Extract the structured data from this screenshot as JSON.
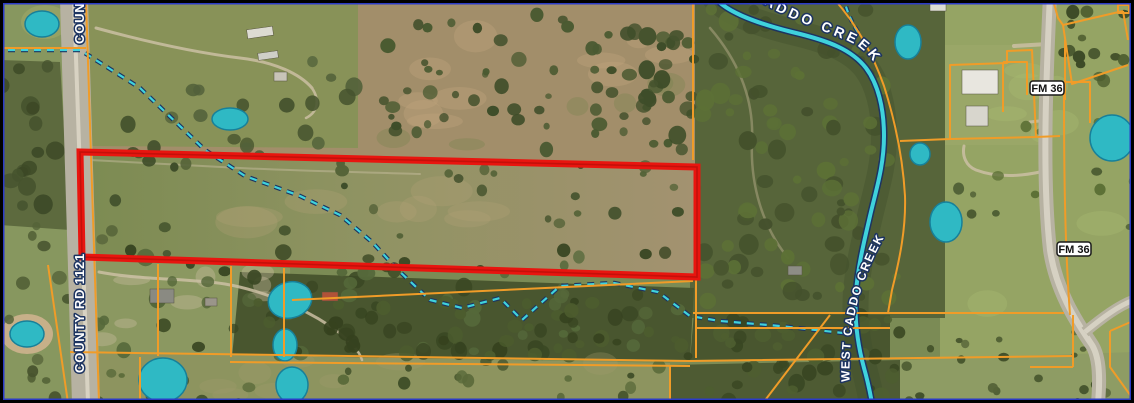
{
  "map": {
    "labels": {
      "county_road": "COUNTY RD 1121",
      "caddo_creek": "CADDO CREEK",
      "west_caddo_creek": "WEST CADDO CREEK",
      "fm36": "FM 36"
    },
    "colors": {
      "parcel_line": "#F09C28",
      "highlight": "#E8150F",
      "highlight_core": "#A50D08",
      "water": "#3FD2DC",
      "water_casing": "#1D3461",
      "road": "#B7B2A2",
      "border_outer": "#000000",
      "border_inner": "#2B3BC7",
      "label_text": "#FFFFFF",
      "label_outline": "#1D3461",
      "badge_bg": "#FFFFFF",
      "badge_border": "#1A1A1A",
      "badge_text": "#111111"
    }
  }
}
